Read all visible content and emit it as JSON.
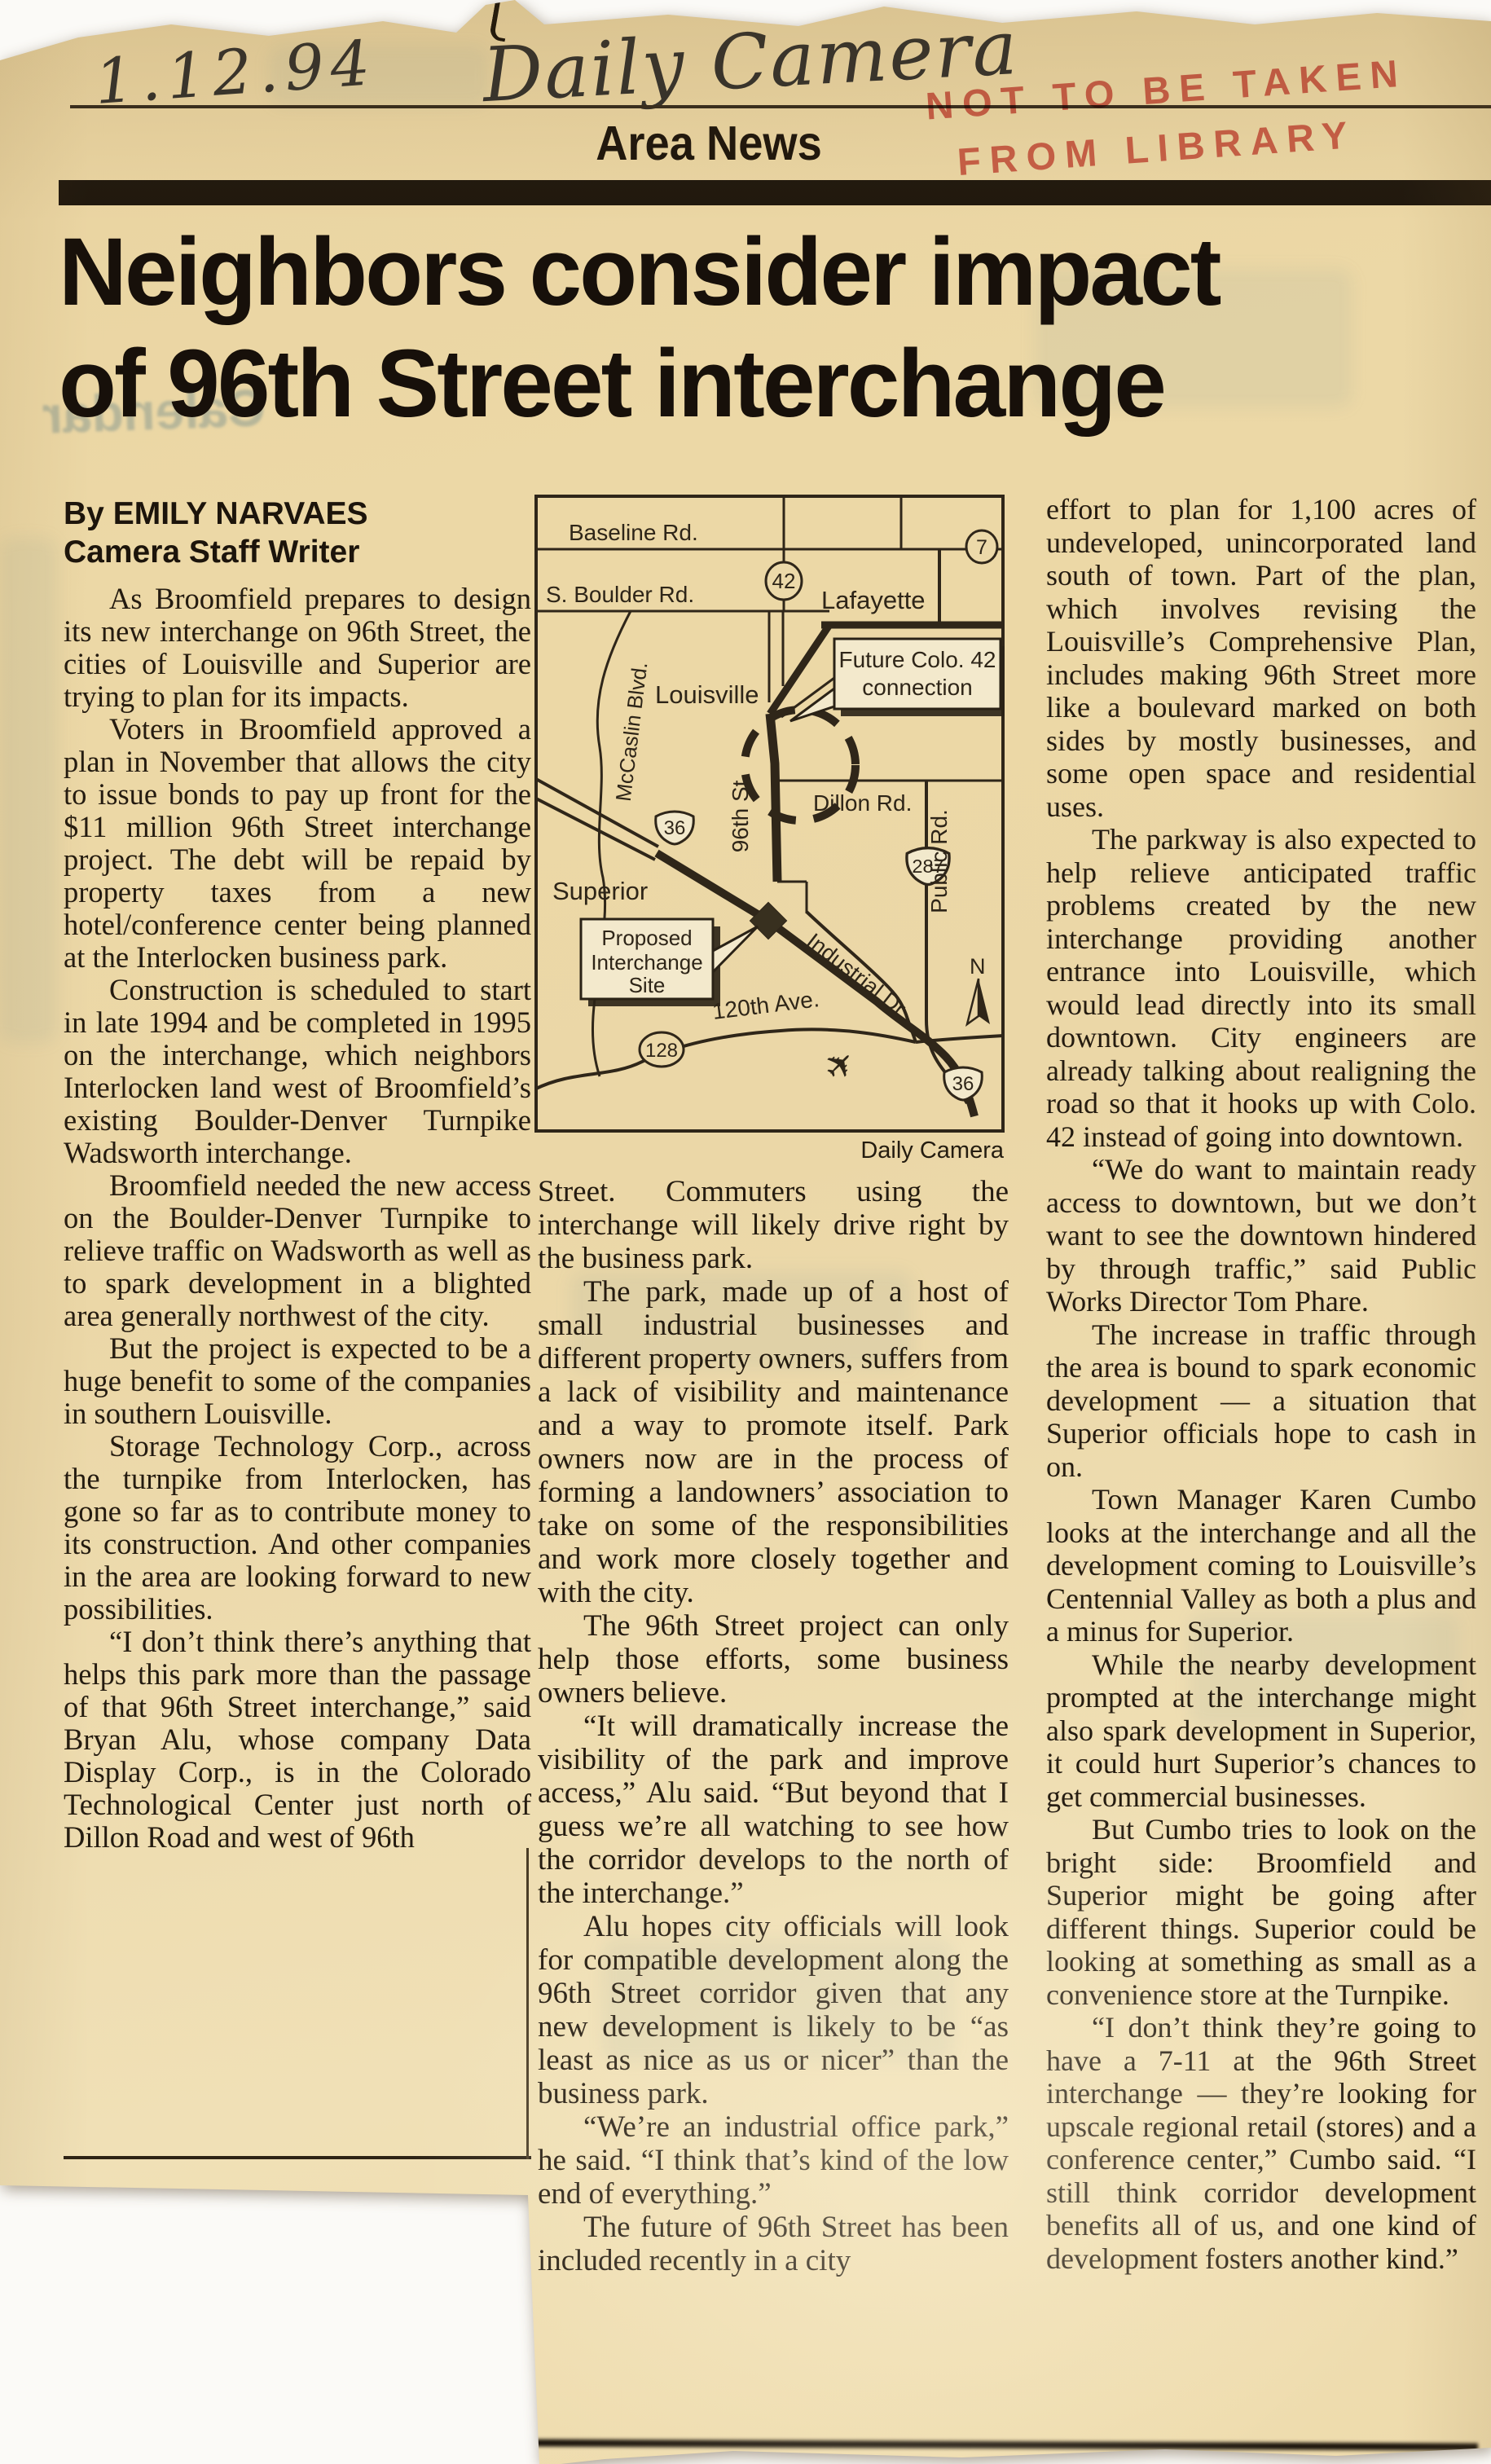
{
  "annotations": {
    "handwritten_date": "1.12.94",
    "publication_script": "Daily Camera",
    "stamp_line1": "NOT TO BE TAKEN",
    "stamp_line2": "FROM LIBRARY",
    "ghost_showthrough": "Calendar"
  },
  "masthead": {
    "section": "Area News"
  },
  "headline": {
    "line1": "Neighbors consider impact",
    "line2": "of 96th Street interchange"
  },
  "byline": {
    "author": "By EMILY NARVAES",
    "title": "Camera Staff Writer"
  },
  "columns": {
    "col1": [
      "As Broomfield prepares to design its new interchange on 96th Street, the cities of Louisville and Superior are trying to plan for its impacts.",
      "Voters in Broomfield approved a plan in November that allows the city to issue bonds to pay up front for the $11 million 96th Street interchange project. The debt will be repaid by property taxes from a new hotel/conference center being planned at the Interlocken business park.",
      "Construction is scheduled to start in late 1994 and be completed in 1995 on the interchange, which neighbors Interlocken land west of Broomfield’s existing Boulder-Denver Turnpike Wadsworth interchange.",
      "Broomfield needed the new access on the Boulder-Denver Turnpike to relieve traffic on Wadsworth as well as to spark development in a blighted area generally northwest of the city.",
      "But the project is expected to be a huge benefit to some of the companies in southern Louisville.",
      "Storage Technology Corp., across the turnpike from Interlocken, has gone so far as to contribute money to its construction. And other companies in the area are looking forward to new possibilities.",
      "“I don’t think there’s anything that helps this park more than the passage of that 96th Street interchange,” said Bryan Alu, whose company Data Display Corp., is in the Colorado Technological Center just north of Dillon Road and west of 96th"
    ],
    "col2": [
      "Street. Commuters using the interchange will likely drive right by the business park.",
      "The park, made up of a host of small industrial businesses and different property owners, suffers from a lack of visibility and maintenance and a way to promote itself. Park owners now are in the process of forming a landowners’ association to take on some of the responsibilities and work more closely together and with the city.",
      "The 96th Street project can only help those efforts, some business owners believe.",
      "“It will dramatically increase the visibility of the park and improve access,” Alu said. “But beyond that I guess we’re all watching to see how the corridor develops to the north of the interchange.”",
      "Alu hopes city officials will look for compatible development along the 96th Street corridor given that any new development is likely to be “as least as nice as us or nicer” than the business park.",
      "“We’re an industrial office park,” he said. “I think that’s kind of the low end of everything.”",
      "The future of 96th Street has been included recently in a city"
    ],
    "col3": [
      "effort to plan for 1,100 acres of undeveloped, unincorporated land south of town. Part of the plan, which involves revising the Louisville’s Comprehensive Plan, includes making 96th Street more like a boulevard marked on both sides by mostly businesses, and some open space and residential uses.",
      "The parkway is also expected to help relieve anticipated traffic problems created by the new interchange providing another entrance into Louisville, which would lead directly into its small downtown. City engineers are already talking about realigning the road so that it hooks up with Colo. 42 instead of going into downtown.",
      "“We do want to maintain ready access to downtown, but we don’t want to see the downtown hindered by through traffic,” said Public Works Director Tom Phare.",
      "The increase in traffic through the area is bound to spark economic development — a situation that Superior officials hope to cash in on.",
      "Town Manager Karen Cumbo looks at the interchange and all the development coming to Louisville’s Centennial Valley as both a plus and a minus for Superior.",
      "While the nearby development prompted at the interchange might also spark development in Superior, it could hurt Superior’s chances to get commercial businesses.",
      "But Cumbo tries to look on the bright side: Broomfield and Superior might be going after different things. Superior could be looking at something as small as a convenience store at the Turnpike.",
      "“I don’t think they’re going to have a 7-11 at the 96th Street interchange — they’re looking for upscale regional retail (stores) and a conference center,” Cumbo said. “I still think corridor development benefits all of us, and one kind of development fosters another kind.”"
    ]
  },
  "map": {
    "credit": "Daily Camera",
    "labels": {
      "baseline_rd": "Baseline Rd.",
      "s_boulder_rd": "S. Boulder Rd.",
      "mccaslin_blvd": "McCaslin Blvd.",
      "louisville": "Louisville",
      "lafayette": "Lafayette",
      "superior": "Superior",
      "dillon_rd": "Dillon Rd.",
      "public_rd": "Public Rd.",
      "ninety_sixth_st": "96th St.",
      "industrial_dr": "Industrial Dr.",
      "ave_120th": "120th Ave.",
      "north": "N"
    },
    "badges": {
      "colo_42": "42",
      "colo_7": "7",
      "us_36_west": "36",
      "us_287": "287",
      "colo_128": "128",
      "us_36_south": "36"
    },
    "callouts": {
      "future_line1": "Future Colo. 42",
      "future_line2": "connection",
      "proposed_line1": "Proposed",
      "proposed_line2": "Interchange",
      "proposed_line3": "Site"
    }
  },
  "colors": {
    "paper": "#ecd8a6",
    "ink": "#241b10",
    "stamp_red": "#cf4a45",
    "bar_black": "#20180e"
  }
}
